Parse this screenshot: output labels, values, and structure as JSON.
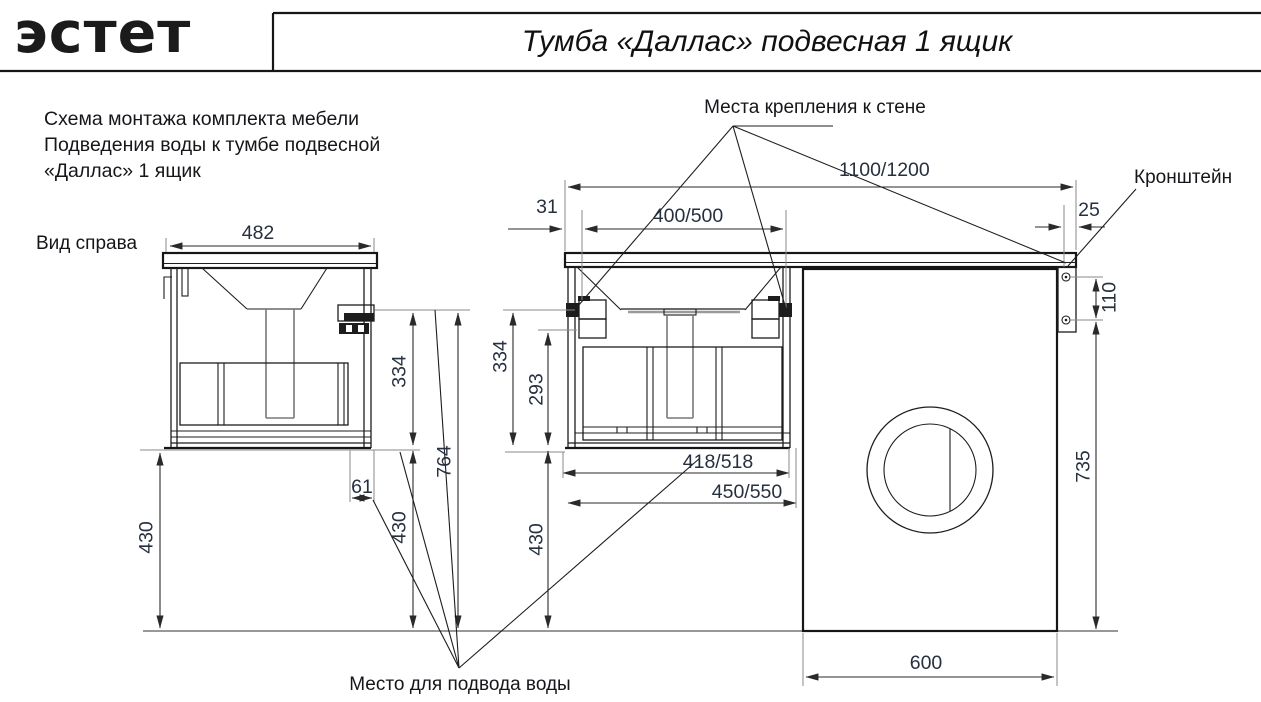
{
  "header": {
    "logo_text": "эстет",
    "title": "Тумба «Даллас» подвесная 1 ящик"
  },
  "description": {
    "line1": "Схема монтажа комплекта мебели",
    "line2": "Подведения воды к тумбе подвесной",
    "line3": "«Даллас» 1 ящик"
  },
  "labels": {
    "view": "Вид справа",
    "wall_mount": "Места крепления к стене",
    "bracket": "Кронштейн",
    "water": "Место для подвода воды"
  },
  "dimensions": {
    "side_width": "482",
    "side_upper": "334",
    "side_total": "764",
    "side_left_height": "430",
    "side_lower": "430",
    "water_offset": "61",
    "counter_left_offset": "31",
    "mount_spacing": "400/500",
    "counter_width": "1100/1200",
    "bracket_offset": "25",
    "front_upper": "334",
    "front_inner": "293",
    "drawer_width": "418/518",
    "cabinet_width": "450/550",
    "front_lower": "430",
    "bracket_screws": "110",
    "washer_height": "735",
    "washer_width": "600"
  },
  "colors": {
    "line": "#1d1d1d",
    "dim_text": "#26303f",
    "background": "#ffffff"
  }
}
